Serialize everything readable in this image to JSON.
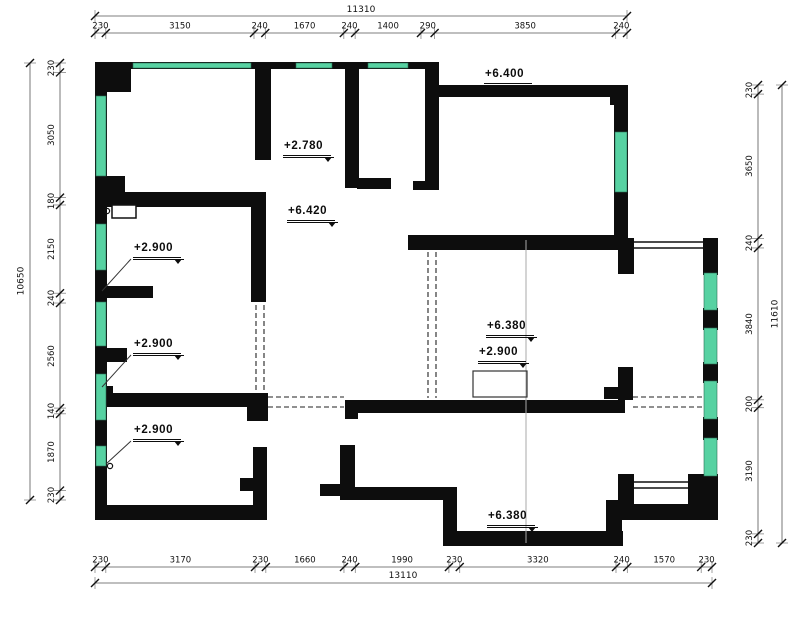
{
  "drawing": {
    "type": "floor-plan",
    "units": "mm"
  },
  "colors": {
    "wall": "#0d0d0d",
    "window": "#57d2a2",
    "window_edge": "#2a6f56",
    "dim_line": "#555555",
    "ext_line": "#777777",
    "tick": "#111111",
    "dash_line": "#222222",
    "grid_line": "#aaaaaa",
    "text": "#111111",
    "background": "#ffffff"
  },
  "dimensions": {
    "top": {
      "total": "11310",
      "segments": [
        "230",
        "3150",
        "240",
        "1670",
        "240",
        "1400",
        "290",
        "3850",
        "240"
      ]
    },
    "bottom": {
      "total": "13110",
      "segments": [
        "230",
        "3170",
        "230",
        "1660",
        "240",
        "1990",
        "230",
        "3320",
        "240",
        "1570",
        "230"
      ]
    },
    "left": {
      "total": "10650",
      "segments": [
        "230",
        "3050",
        "180",
        "2150",
        "240",
        "2560",
        "140",
        "1870",
        "230"
      ]
    },
    "right": {
      "total": "11610",
      "segments": [
        "230",
        "3650",
        "240",
        "3840",
        "200",
        "3190",
        "230"
      ]
    }
  },
  "elevation_labels": [
    {
      "text": "+6.400",
      "x": 484,
      "y": 69
    },
    {
      "text": "+2.780",
      "x": 283,
      "y": 141
    },
    {
      "text": "+6.420",
      "x": 287,
      "y": 206
    },
    {
      "text": "+2.900",
      "x": 133,
      "y": 243,
      "leader": [
        131,
        259,
        102,
        291
      ]
    },
    {
      "text": "+2.900",
      "x": 133,
      "y": 339,
      "leader": [
        131,
        355,
        102,
        387
      ]
    },
    {
      "text": "+2.900",
      "x": 133,
      "y": 425,
      "leader": [
        131,
        441,
        106,
        464
      ]
    },
    {
      "text": "+6.380",
      "x": 486,
      "y": 321
    },
    {
      "text": "+2.900",
      "x": 478,
      "y": 347
    },
    {
      "text": "+6.380",
      "x": 487,
      "y": 511
    }
  ]
}
